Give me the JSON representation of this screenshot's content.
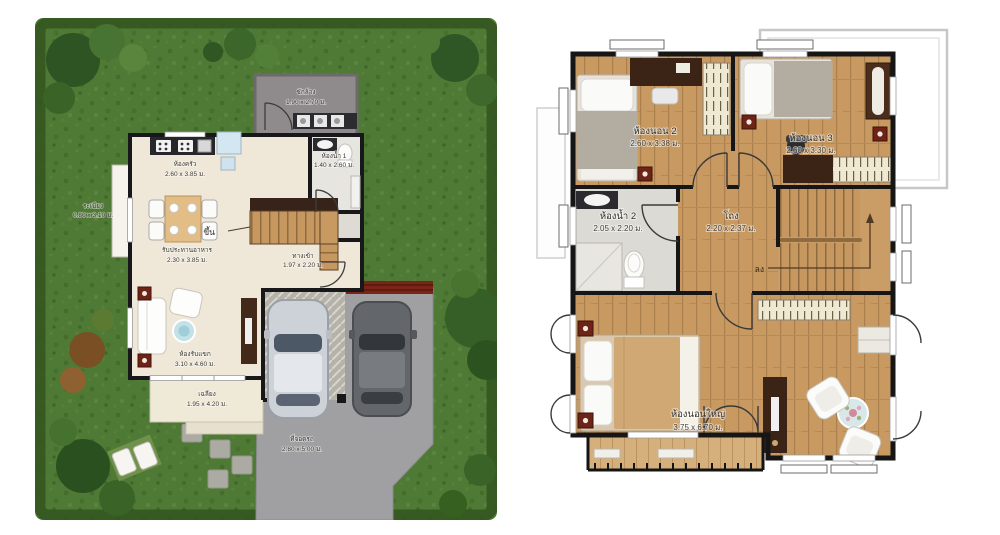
{
  "page": {
    "background": "#ffffff",
    "description": "Two-storey house floor plans: ground floor with garden lot (left) and second floor (right)"
  },
  "colors": {
    "grass": "#4f7a35",
    "hedge": "#33541f",
    "wall": "#18181a",
    "wood_floor": "#c89a62",
    "driveway": "#a0a0a2",
    "cream_floor": "#efe8d9",
    "pergola_red": "#7b2518",
    "fixture_red": "#6e2317",
    "roof_outline": "#c7c7c7",
    "closet": "#efe8d2"
  },
  "ground_floor": {
    "laundry": {
      "label": "ซักล้าง",
      "dim": "1.90 x 2.70 ม."
    },
    "kitchen": {
      "label": "ห้องครัว",
      "dim": "2.60 x 3.85 ม."
    },
    "bathroom1": {
      "label": "ห้องน้ำ 1",
      "dim": "1.40 x 2.60 ม."
    },
    "dining": {
      "label": "รับประทานอาหาร",
      "dim": "2.30 x 3.85 ม."
    },
    "stairs": {
      "label": "ขึ้น"
    },
    "entrance": {
      "label": "ทางเข้า",
      "dim": "1.97 x 2.20 ม."
    },
    "living": {
      "label": "ห้องรับแขก",
      "dim": "3.10 x 4.60 ม."
    },
    "porch": {
      "label": "เฉลียง",
      "dim": "1.95 x 4.20 ม."
    },
    "carpark": {
      "label": "ที่จอดรถ",
      "dim": "2.80 x 5.00 ม."
    },
    "side_ledge": {
      "label": "ระเบียง",
      "dim": "0.80 x 3.10 ม."
    }
  },
  "second_floor": {
    "bedroom2": {
      "label": "ห้องนอน 2",
      "dim": "2.60 x 3.38 ม."
    },
    "bedroom3": {
      "label": "ห้องนอน 3",
      "dim": "2.60 x 3.30 ม."
    },
    "bathroom2": {
      "label": "ห้องน้ำ 2",
      "dim": "2.05 x 2.20 ม."
    },
    "hall": {
      "label": "โถง",
      "dim": "2.20 x 2.37 ม."
    },
    "stairs": {
      "label": "ลง"
    },
    "master": {
      "label": "ห้องนอนใหญ่",
      "dim": "3.75 x 6.70 ม."
    }
  }
}
